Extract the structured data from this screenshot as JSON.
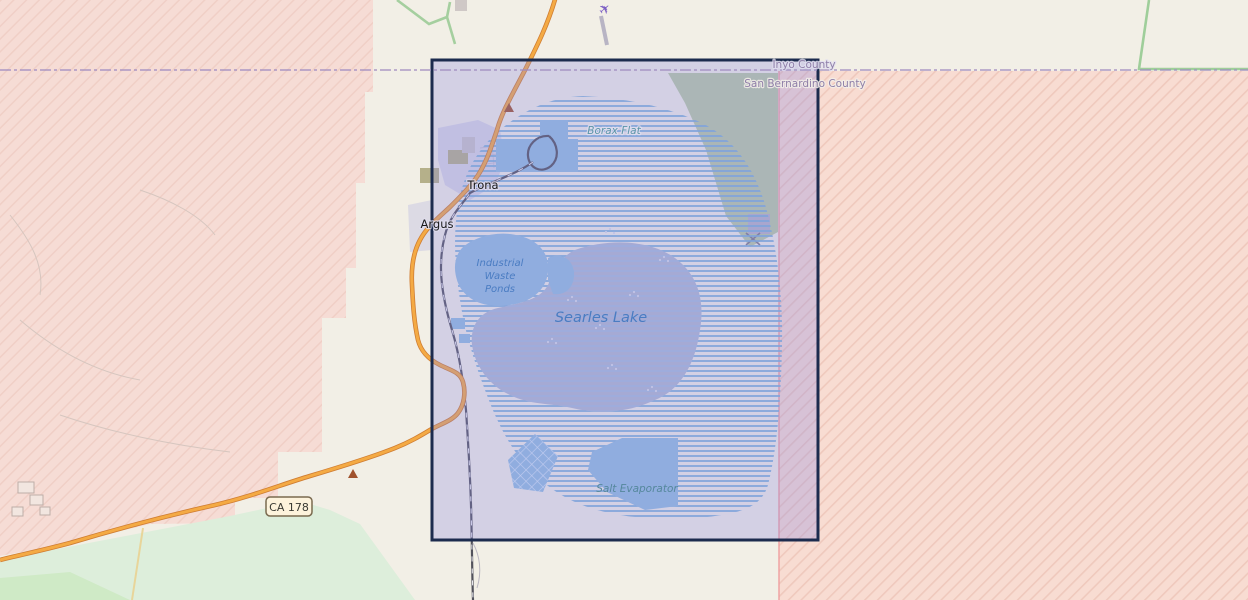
{
  "map": {
    "labels": {
      "town_trona": "Trona",
      "town_argus": "Argus",
      "locality_borax_flat": "Borax Flat",
      "lake_name": "Searles Lake",
      "waste_ponds_line1": "Industrial",
      "waste_ponds_line2": "Waste",
      "waste_ponds_line3": "Ponds",
      "salt_evaporator": "Salt Evaporator",
      "county_north": "Inyo County",
      "county_south": "San Bernardino County",
      "road_shield": "CA 178"
    },
    "colors": {
      "background": "#f2efe6",
      "selection_border": "#1c2b4e",
      "selection_fill": "#8c87e1",
      "military_pink": "#f7dcd3",
      "military_hatch": "#efc9bd",
      "military_border_red": "#ef9f9f",
      "water_blue": "#92bede",
      "lake_stripe_blue": "#7cb0d8",
      "mudflat_grey": "#b1b9cf",
      "vegetation_green": "#b9cba4",
      "meadow_green": "#ddeedb",
      "road_orange": "#f4aa44",
      "road_casing": "#cf7d33",
      "railway_dark": "#52525c",
      "county_boundary": "#a08cc0",
      "county_label": "#8f7fa8",
      "water_label": "#4a7cc2",
      "locality_label": "#5d95a8",
      "town_label": "#1a1a1a",
      "airplane_purple": "#7c5fc4",
      "peak_brown": "#a0522d"
    }
  }
}
